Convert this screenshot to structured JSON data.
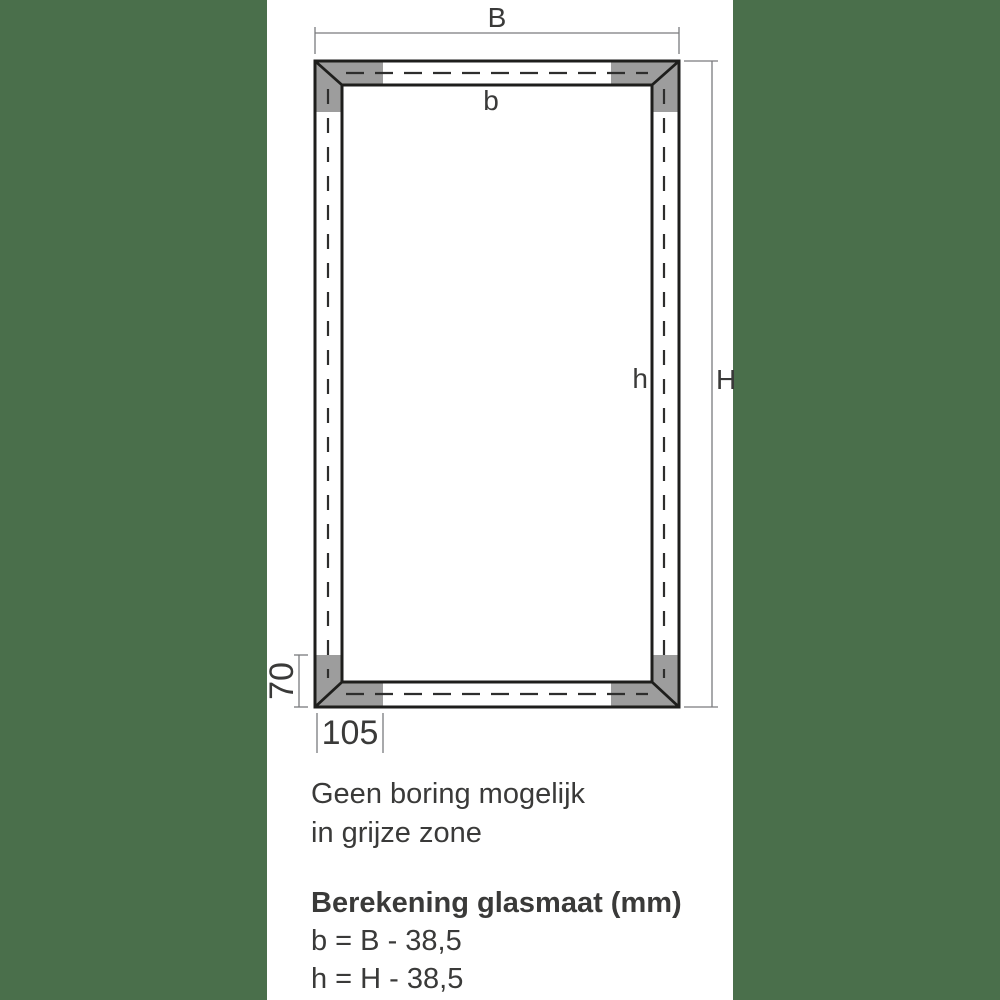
{
  "colors": {
    "matte_green": "#4a6f4b",
    "no_drill_zone_gray": "#9d9d9d",
    "frame_line_black": "#1e1e1c",
    "dimension_line_gray": "#7a7b7e",
    "text_dark": "#3a3a39",
    "background": "#ffffff"
  },
  "diagram": {
    "labels": {
      "frame_width": "B",
      "glass_width": "b",
      "frame_height": "H",
      "glass_height": "h",
      "zone_height": "70",
      "zone_width": "105"
    }
  },
  "note": {
    "line1": "Geen boring mogelijk",
    "line2": "in grijze zone"
  },
  "formulas": {
    "title": "Berekening glasmaat (mm)",
    "width": "b = B - 38,5",
    "height": "h = H - 38,5"
  }
}
